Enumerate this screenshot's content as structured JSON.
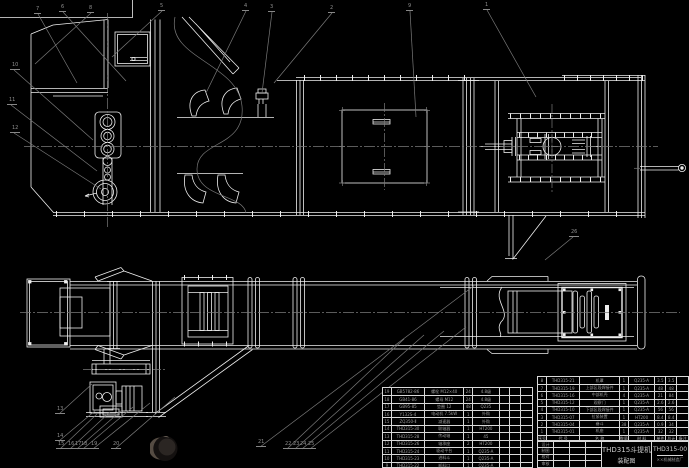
{
  "drawing": {
    "title": "THD315斗提机",
    "subtitle": "装配图",
    "drawing_no": "THD315-00",
    "company": "××机械制造厂",
    "colors": {
      "background": "#000000",
      "line_white": "#eeeeee",
      "line_gray": "#7a7a7a",
      "table_text": "#9c9c9c"
    }
  },
  "title_block": {
    "signature_labels": [
      "设计",
      "制图",
      "校对",
      "审核"
    ]
  },
  "bom": {
    "header": [
      "序号",
      "代 号",
      "名 称",
      "数量",
      "材 料",
      "单件",
      "总计",
      "备注"
    ],
    "right_rows": [
      [
        "8",
        "THD315-21",
        "机罩",
        "1",
        "Q235-A",
        "3.5",
        "3.5",
        ""
      ],
      [
        "7",
        "THD315-19",
        "上部区段焊接件",
        "1",
        "Q235-A",
        "48",
        "48",
        ""
      ],
      [
        "6",
        "THD315-16",
        "中部机壳",
        "4",
        "Q235-A",
        "21",
        "84",
        ""
      ],
      [
        "5",
        "THD315-12",
        "观察门",
        "1",
        "Q235-A",
        "2.6",
        "2.6",
        ""
      ],
      [
        "4",
        "THD315-10",
        "下部区段焊接件",
        "1",
        "Q235-A",
        "56",
        "56",
        ""
      ],
      [
        "3",
        "THD315-07",
        "拉紧装置",
        "1",
        "HT200",
        "8.4",
        "8.4",
        ""
      ],
      [
        "2",
        "THD315-04",
        "畚斗",
        "38",
        "Q235-A",
        "0.9",
        "34",
        ""
      ],
      [
        "1",
        "THD315-01",
        "机座",
        "1",
        "Q235-A",
        "32",
        "32",
        ""
      ]
    ],
    "left_rows": [
      [
        "19",
        "GB5782-86",
        "螺栓 M12×40",
        "24",
        "4.8级",
        "",
        "",
        ""
      ],
      [
        "18",
        "GB41-86",
        "螺母 M12",
        "24",
        "4.8级",
        "",
        "",
        ""
      ],
      [
        "17",
        "GB95-85",
        "垫圈 12",
        "48",
        "Q235",
        "",
        "",
        ""
      ],
      [
        "16",
        "Y132S-4",
        "电动机 7.5kW",
        "1",
        "外购",
        "",
        "",
        ""
      ],
      [
        "15",
        "ZQ350-Ⅱ",
        "减速器",
        "1",
        "外购",
        "",
        "",
        ""
      ],
      [
        "14",
        "THD315-30",
        "联轴器",
        "1",
        "HT200",
        "",
        "",
        ""
      ],
      [
        "13",
        "THD315-28",
        "传动轴",
        "1",
        "45",
        "",
        "",
        ""
      ],
      [
        "12",
        "THD315-26",
        "轴承座",
        "2",
        "HT200",
        "",
        "",
        ""
      ],
      [
        "11",
        "THD315-24",
        "驱动平台",
        "1",
        "Q235-A",
        "",
        "",
        ""
      ],
      [
        "10",
        "THD315-23",
        "进料斗",
        "1",
        "Q235-A",
        "",
        "",
        ""
      ],
      [
        "9",
        "THD315-22",
        "卸料口",
        "1",
        "Q235-A",
        "",
        "",
        ""
      ]
    ]
  },
  "balloons": [
    {
      "n": "7",
      "x": 36,
      "y": 14,
      "tx": 77,
      "ty": 83
    },
    {
      "n": "6",
      "x": 61,
      "y": 12,
      "tx": 126,
      "ty": 81
    },
    {
      "n": "8",
      "x": 89,
      "y": 13,
      "tx": 35,
      "ty": 64
    },
    {
      "n": "5",
      "x": 160,
      "y": 11,
      "tx": 112,
      "ty": 57
    },
    {
      "n": "4",
      "x": 244,
      "y": 11,
      "tx": 206,
      "ty": 93
    },
    {
      "n": "3",
      "x": 270,
      "y": 12,
      "tx": 262,
      "ty": 93
    },
    {
      "n": "2",
      "x": 330,
      "y": 13,
      "tx": 274,
      "ty": 83
    },
    {
      "n": "9",
      "x": 408,
      "y": 11,
      "tx": 416,
      "ty": 117
    },
    {
      "n": "1",
      "x": 485,
      "y": 10,
      "tx": 536,
      "ty": 97
    },
    {
      "n": "10",
      "x": 12,
      "y": 70,
      "tx": 93,
      "ty": 140
    },
    {
      "n": "11",
      "x": 9,
      "y": 105,
      "tx": 97,
      "ty": 171
    },
    {
      "n": "12",
      "x": 12,
      "y": 133,
      "tx": 101,
      "ty": 189
    },
    {
      "n": "13",
      "x": 57,
      "y": 414,
      "tx": 92,
      "ty": 384
    },
    {
      "n": "14",
      "x": 57,
      "y": 441,
      "tx": 96,
      "ty": 410
    },
    {
      "n": "15",
      "x": 58,
      "y": 449,
      "tx": 97,
      "ty": 414
    },
    {
      "n": "16",
      "x": 68,
      "y": 449,
      "tx": 110,
      "ty": 412
    },
    {
      "n": "17",
      "x": 75,
      "y": 449,
      "tx": 122,
      "ty": 410
    },
    {
      "n": "18",
      "x": 81,
      "y": 449,
      "tx": 133,
      "ty": 407
    },
    {
      "n": "19",
      "x": 91,
      "y": 449,
      "tx": 150,
      "ty": 403
    },
    {
      "n": "20",
      "x": 113,
      "y": 449,
      "tx": 175,
      "ty": 397
    },
    {
      "n": "21",
      "x": 258,
      "y": 447,
      "tx": 475,
      "ty": 285
    },
    {
      "n": "22",
      "x": 285,
      "y": 449,
      "tx": 404,
      "ty": 339
    },
    {
      "n": "23",
      "x": 293,
      "y": 449,
      "tx": 424,
      "ty": 335
    },
    {
      "n": "24",
      "x": 300,
      "y": 449,
      "tx": 444,
      "ty": 331
    },
    {
      "n": "25",
      "x": 308,
      "y": 449,
      "tx": 466,
      "ty": 327
    },
    {
      "n": "26",
      "x": 571,
      "y": 237,
      "tx": 545,
      "ty": 260
    }
  ]
}
